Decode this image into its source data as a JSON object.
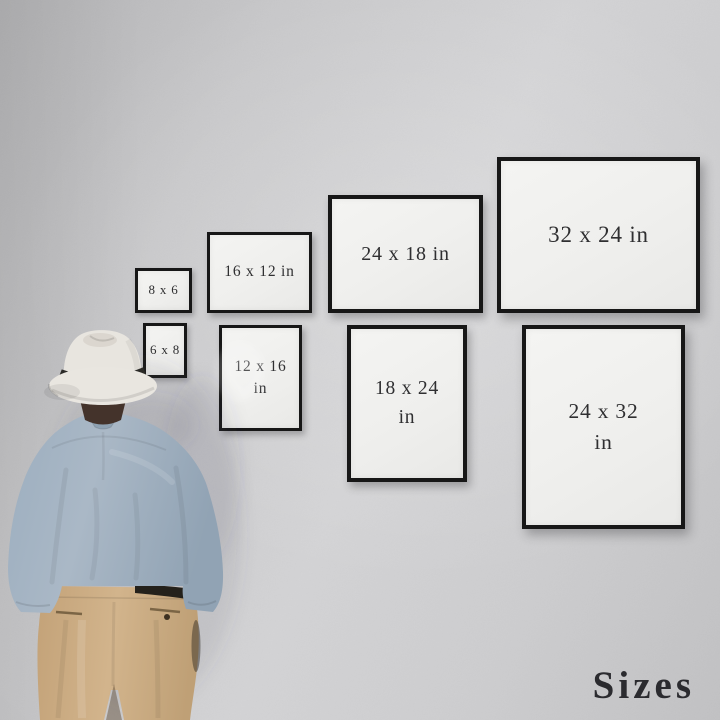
{
  "watermark": "Sizes",
  "frames": [
    {
      "name": "8 x 6",
      "orientation": "landscape",
      "row": "top",
      "line1": "8 x 6",
      "line2": ""
    },
    {
      "name": "16 x 12 in",
      "orientation": "landscape",
      "row": "top",
      "line1": "16 x 12 in",
      "line2": ""
    },
    {
      "name": "24 x 18 in",
      "orientation": "landscape",
      "row": "top",
      "line1": "24 x 18 in",
      "line2": ""
    },
    {
      "name": "32 x 24 in",
      "orientation": "landscape",
      "row": "top",
      "line1": "32 x 24 in",
      "line2": ""
    },
    {
      "name": "6 x 8",
      "orientation": "portrait",
      "row": "bottom",
      "line1": "6 x 8",
      "line2": ""
    },
    {
      "name": "12 x 16 in",
      "orientation": "portrait",
      "row": "bottom",
      "line1": "12 x 16",
      "line2": "in"
    },
    {
      "name": "18 x 24 in",
      "orientation": "portrait",
      "row": "bottom",
      "line1": "18 x 24",
      "line2": "in"
    },
    {
      "name": "24 x 32 in",
      "orientation": "portrait",
      "row": "bottom",
      "line1": "24 x 32",
      "line2": "in"
    }
  ],
  "colors": {
    "wall": "#cbcbcd",
    "frame_border": "#171717",
    "frame_canvas": "#f1f1ef",
    "label_text": "#2f2f31",
    "hat": "#e8e5df",
    "hat_band": "#2b2a27",
    "hair": "#44332b",
    "shirt": "#a2b0c0",
    "pants": "#c9aa80",
    "belt": "#24211b",
    "watermark_text": "#2b2b2f"
  }
}
